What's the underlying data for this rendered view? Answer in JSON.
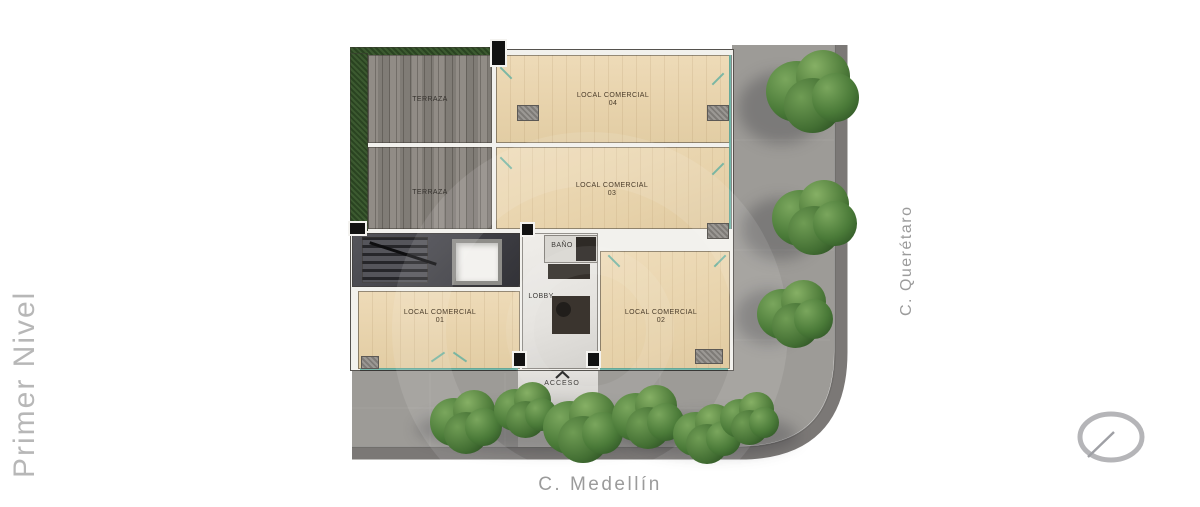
{
  "page": {
    "side_title": "Primer Nivel",
    "street_right": "C. Querétaro",
    "street_bottom": "C. Medellín"
  },
  "rooms": {
    "terraza_top": {
      "label": "TERRAZA"
    },
    "terraza_bottom": {
      "label": "TERRAZA"
    },
    "local_04": {
      "name": "LOCAL COMERCIAL",
      "number": "04"
    },
    "local_03": {
      "name": "LOCAL COMERCIAL",
      "number": "03"
    },
    "local_01": {
      "name": "LOCAL COMERCIAL",
      "number": "01"
    },
    "local_02": {
      "name": "LOCAL COMERCIAL",
      "number": "02"
    },
    "lobby": {
      "label": "LOBBY"
    },
    "bano": {
      "label": "BAÑO"
    },
    "acceso": {
      "label": "ACCESO"
    }
  },
  "icons": {
    "compass": "compass-icon",
    "access_arrow": "chevron-up-icon"
  },
  "colors": {
    "wood": "#e9d6b1",
    "terrace_deck": "#8a857f",
    "sidewalk": "#9d9b97",
    "road": "#7b7876",
    "tree": "#47743a",
    "glass": "#5fafa0",
    "street_text": "#9b9b9b"
  }
}
